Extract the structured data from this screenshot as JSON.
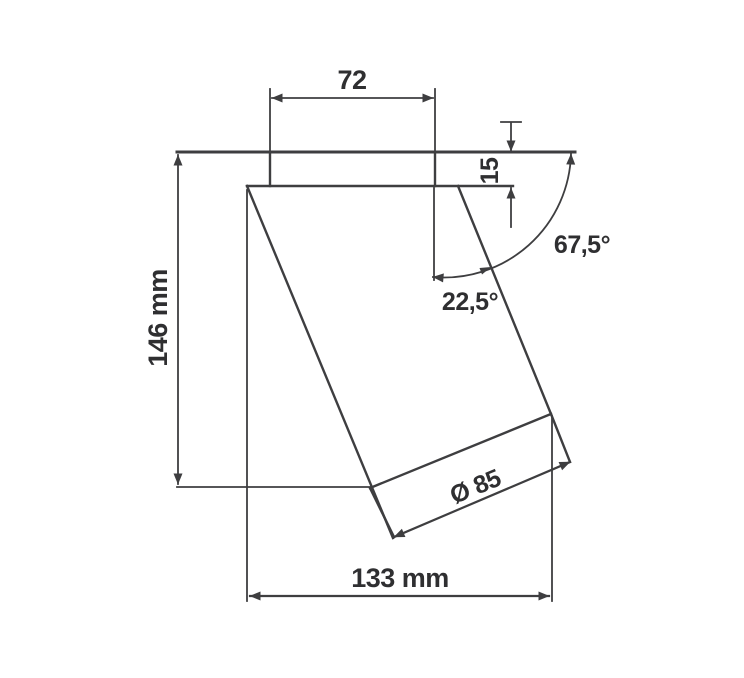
{
  "drawing": {
    "kind": "technical-dimension-drawing",
    "units_shown": "mm",
    "colors": {
      "line": "#3e3e40",
      "text": "#2f2f31",
      "background": "#ffffff"
    },
    "labels": {
      "top_width": "72",
      "canopy_height": "15",
      "overall_height": "146 mm",
      "overall_width": "133 mm",
      "head_diameter": "Ø 85",
      "angle_from_horizontal": "67,5°",
      "angle_from_vertical": "22,5°"
    }
  }
}
